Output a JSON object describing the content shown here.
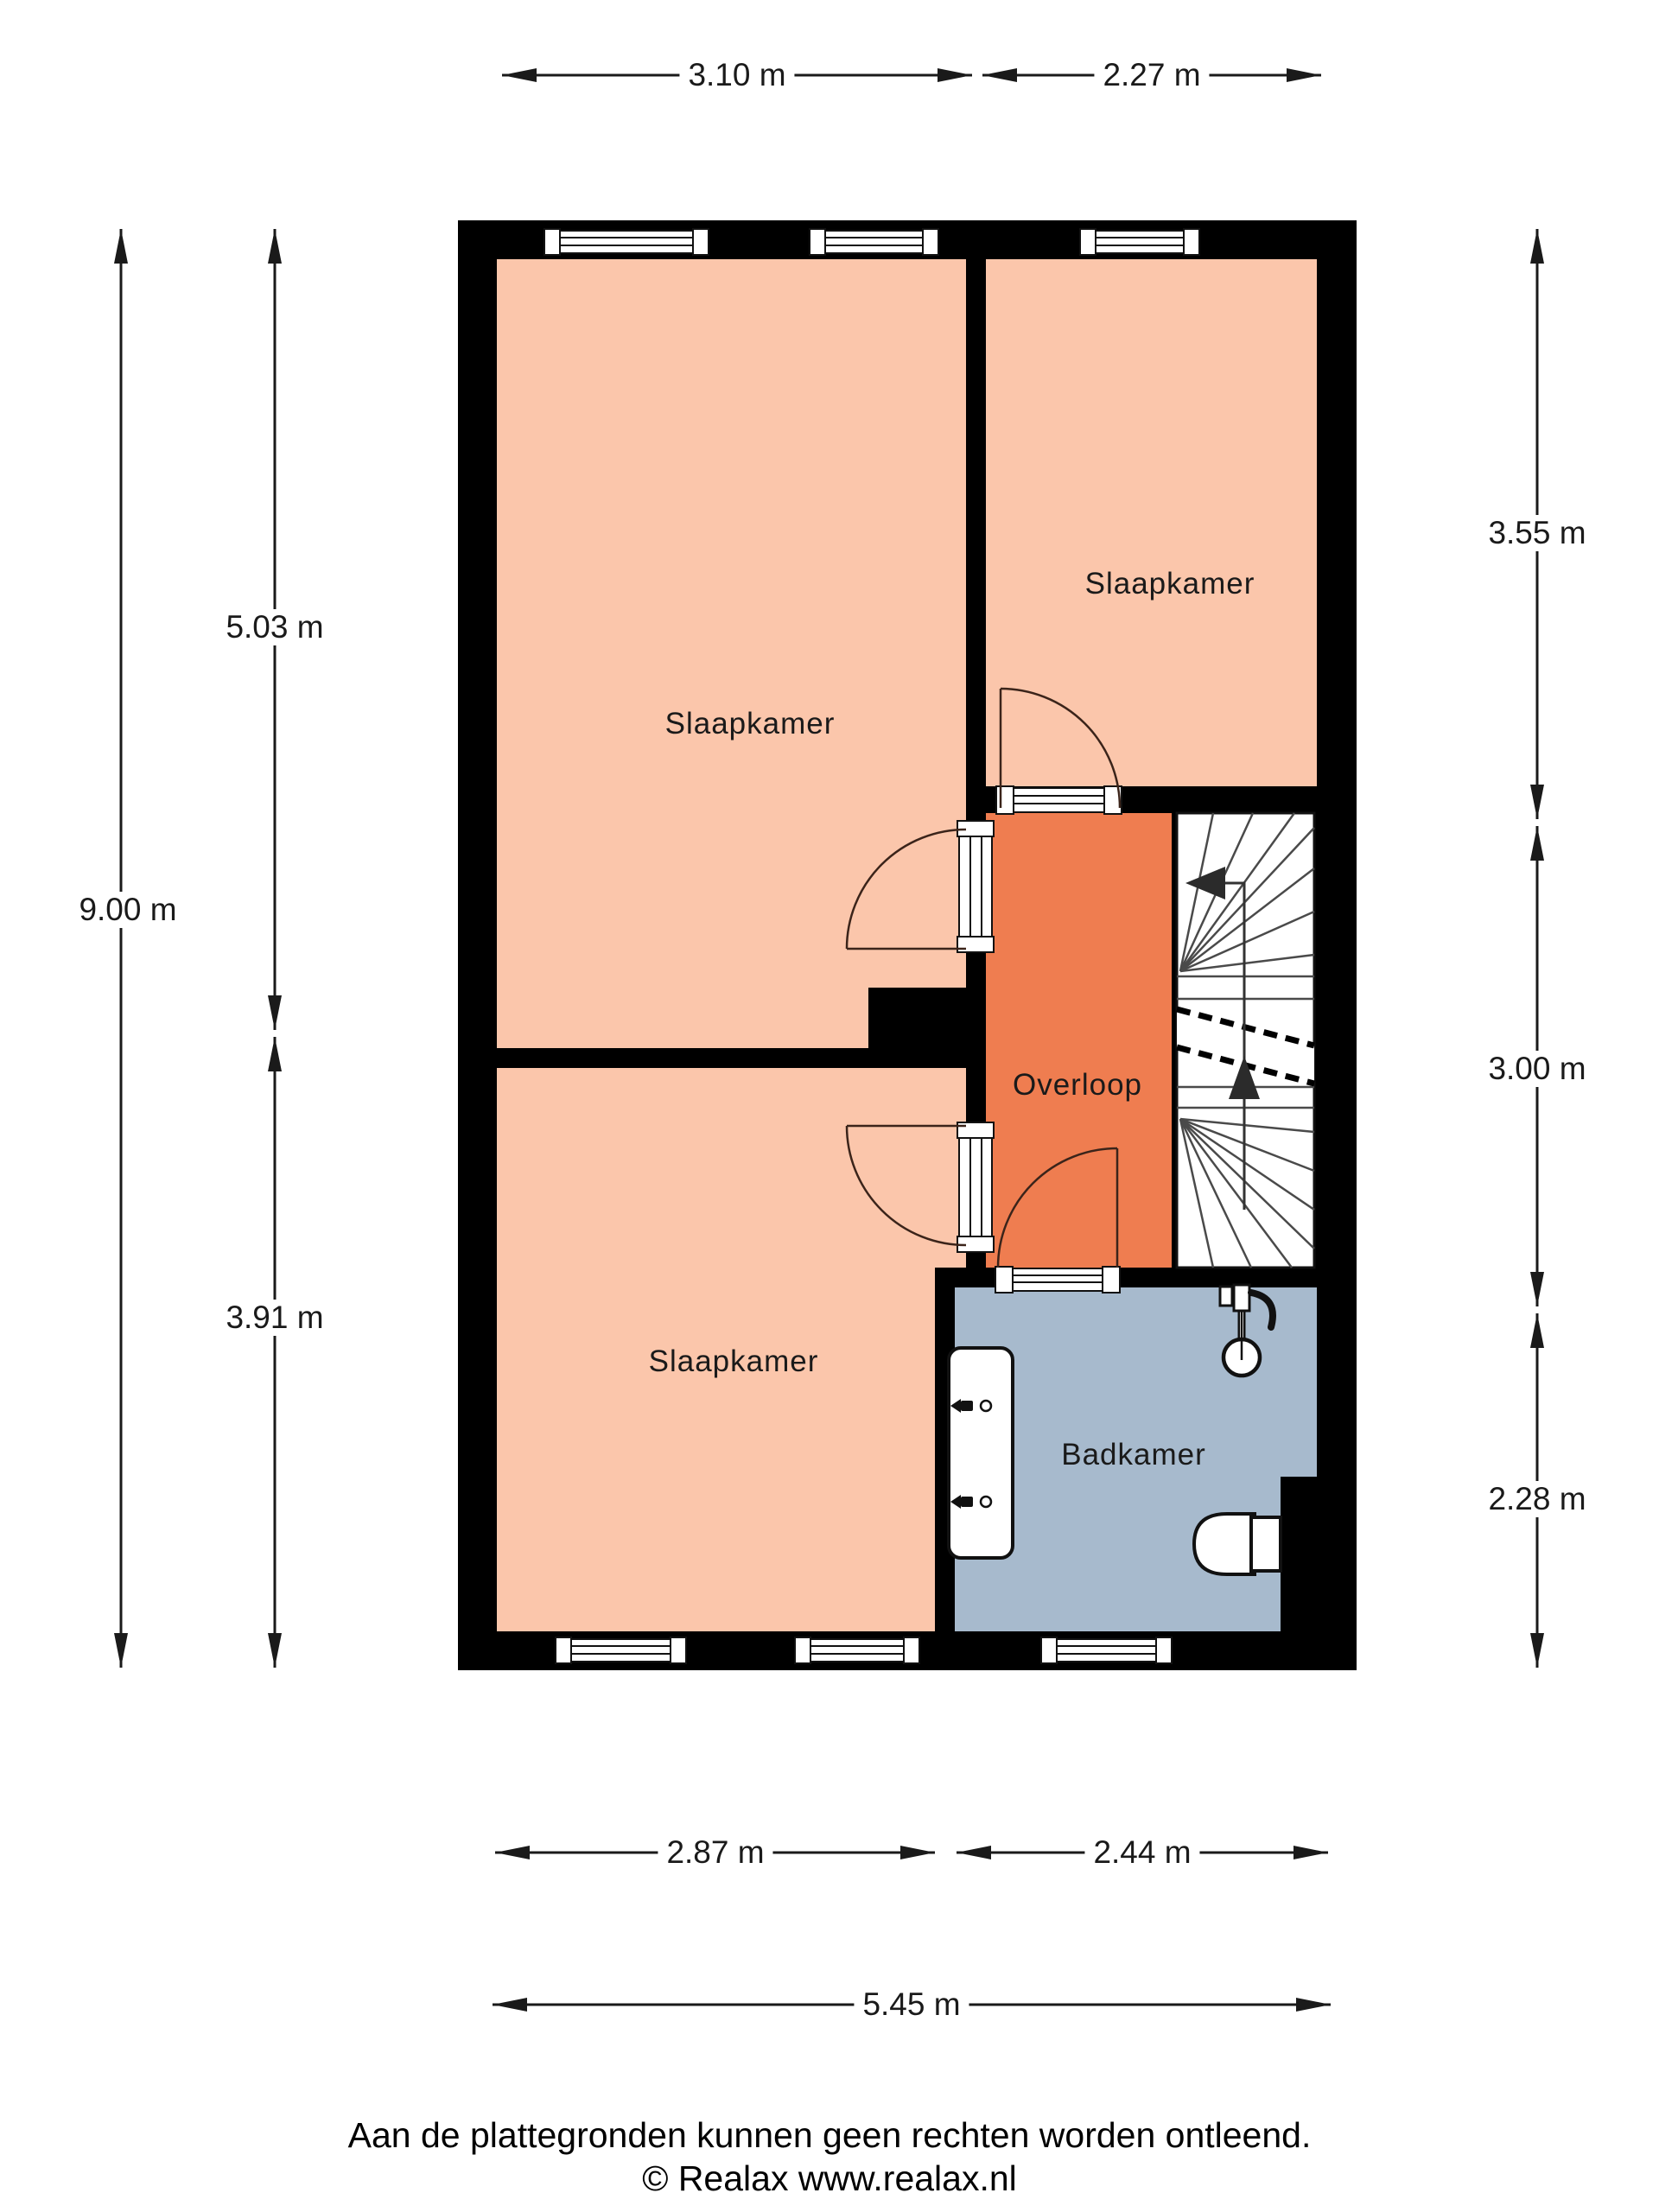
{
  "plan": {
    "type": "floorplan",
    "floor": "verdieping (bedroom floor)"
  },
  "rooms": [
    {
      "id": "slaapkamer-tl",
      "label": "Slaapkamer",
      "color": "#fbc6ab"
    },
    {
      "id": "slaapkamer-tr",
      "label": "Slaapkamer",
      "color": "#fbc6ab"
    },
    {
      "id": "slaapkamer-bl",
      "label": "Slaapkamer",
      "color": "#fbc6ab"
    },
    {
      "id": "overloop",
      "label": "Overloop",
      "color": "#ef7d50"
    },
    {
      "id": "badkamer",
      "label": "Badkamer",
      "color": "#a7bacd"
    }
  ],
  "dimensions": {
    "top": [
      "3.10 m",
      "2.27 m"
    ],
    "left_outer": "9.00 m",
    "left_inner": [
      "5.03 m",
      "3.91 m"
    ],
    "right": [
      "3.55 m",
      "3.00 m",
      "2.28 m"
    ],
    "bottom_inner": [
      "2.87 m",
      "2.44 m"
    ],
    "bottom_outer": "5.45 m"
  },
  "footer": {
    "disclaimer": "Aan de plattegronden kunnen geen rechten worden ontleend.",
    "copyright": "© Realax www.realax.nl"
  },
  "palette": {
    "wall": "#000000",
    "stairwell": "#ffffff",
    "dimension_line": "#1a1a1a",
    "door_arc": "#3b241a"
  }
}
